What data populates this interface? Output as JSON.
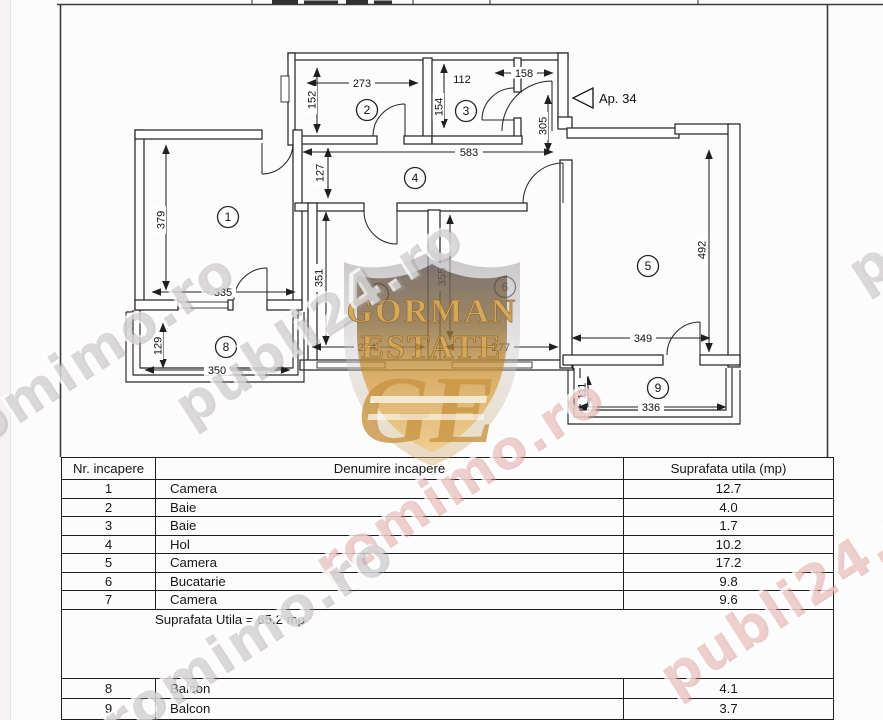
{
  "floor_plan": {
    "apartment_label": "Ap. 34",
    "rooms": [
      {
        "number": "1"
      },
      {
        "number": "2"
      },
      {
        "number": "3"
      },
      {
        "number": "4"
      },
      {
        "number": "5"
      },
      {
        "number": "6"
      },
      {
        "number": "7"
      },
      {
        "number": "8"
      },
      {
        "number": "9"
      }
    ],
    "dimensions": {
      "d273": "273",
      "d152": "152",
      "d112": "112",
      "d154": "154",
      "d158": "158",
      "d305": "305",
      "d583": "583",
      "d127": "127",
      "d379": "379",
      "d335": "335",
      "d129": "129",
      "d350": "350",
      "d351": "351",
      "d274": "274",
      "d355": "355",
      "d277": "277",
      "d492": "492",
      "d349": "349",
      "d111": "111",
      "d336": "336"
    }
  },
  "watermarks": {
    "publi": "publi24.ro",
    "rom": "romimo.ro"
  },
  "logo": {
    "name_line1": "GORMAN",
    "name_line2": "ESTATE",
    "monogram": "GE"
  },
  "table": {
    "headers": {
      "nr": "Nr. incapere",
      "name": "Denumire incapere",
      "area": "Suprafata utila (mp)"
    },
    "rows": [
      {
        "nr": "1",
        "name": "Camera",
        "area": "12.7"
      },
      {
        "nr": "2",
        "name": "Baie",
        "area": "4.0"
      },
      {
        "nr": "3",
        "name": "Baie",
        "area": "1.7"
      },
      {
        "nr": "4",
        "name": "Hol",
        "area": "10.2"
      },
      {
        "nr": "5",
        "name": "Camera",
        "area": "17.2"
      },
      {
        "nr": "6",
        "name": "Bucatarie",
        "area": "9.8"
      },
      {
        "nr": "7",
        "name": "Camera",
        "area": "9.6"
      }
    ],
    "total_note": "Suprafata Utila  = 65.2 mp",
    "extra_rows": [
      {
        "nr": "8",
        "name": "Balcon",
        "area": "4.1"
      },
      {
        "nr": "9",
        "name": "Balcon",
        "area": "3.7"
      }
    ]
  }
}
